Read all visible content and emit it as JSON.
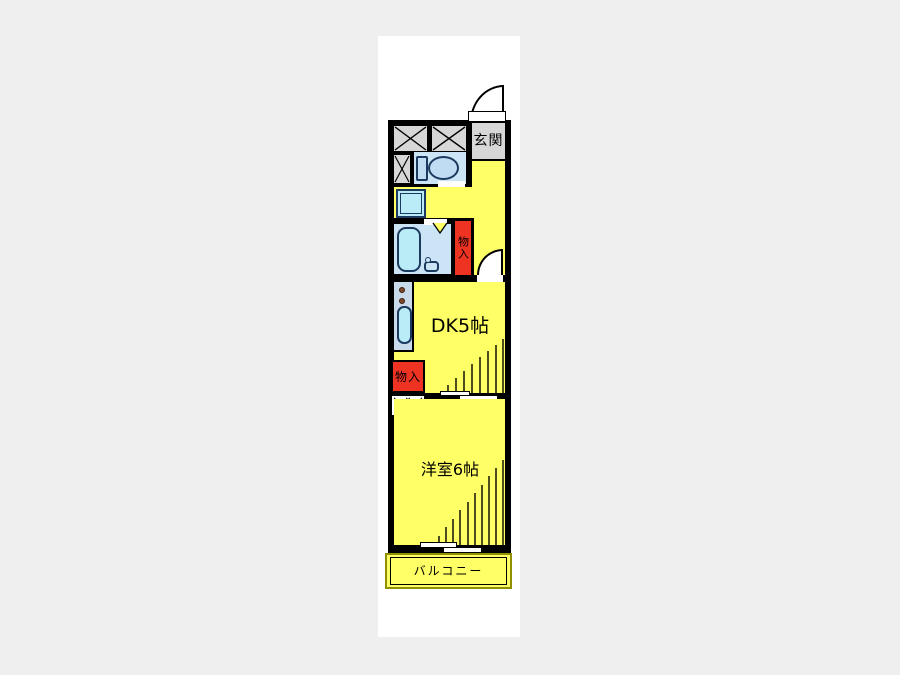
{
  "floorplan": {
    "entrance_label": "玄関",
    "storage_upper_label": "物入",
    "storage_lower_label": "物入",
    "dining_kitchen_label": "DK5帖",
    "western_room_label": "洋室6帖",
    "balcony_label": "バルコニー",
    "colors": {
      "background_gray": "#EFEFEF",
      "canvas_white": "#FFFFFF",
      "wall_black": "#000000",
      "room_yellow": "#FFFF66",
      "wet_area_blue": "#CBE4F6",
      "fixture_cyan": "#B9ECF6",
      "storage_red": "#EE3322",
      "shaft_gray": "#D7D7D7",
      "balcony_border_olive": "#8F8F00"
    }
  }
}
